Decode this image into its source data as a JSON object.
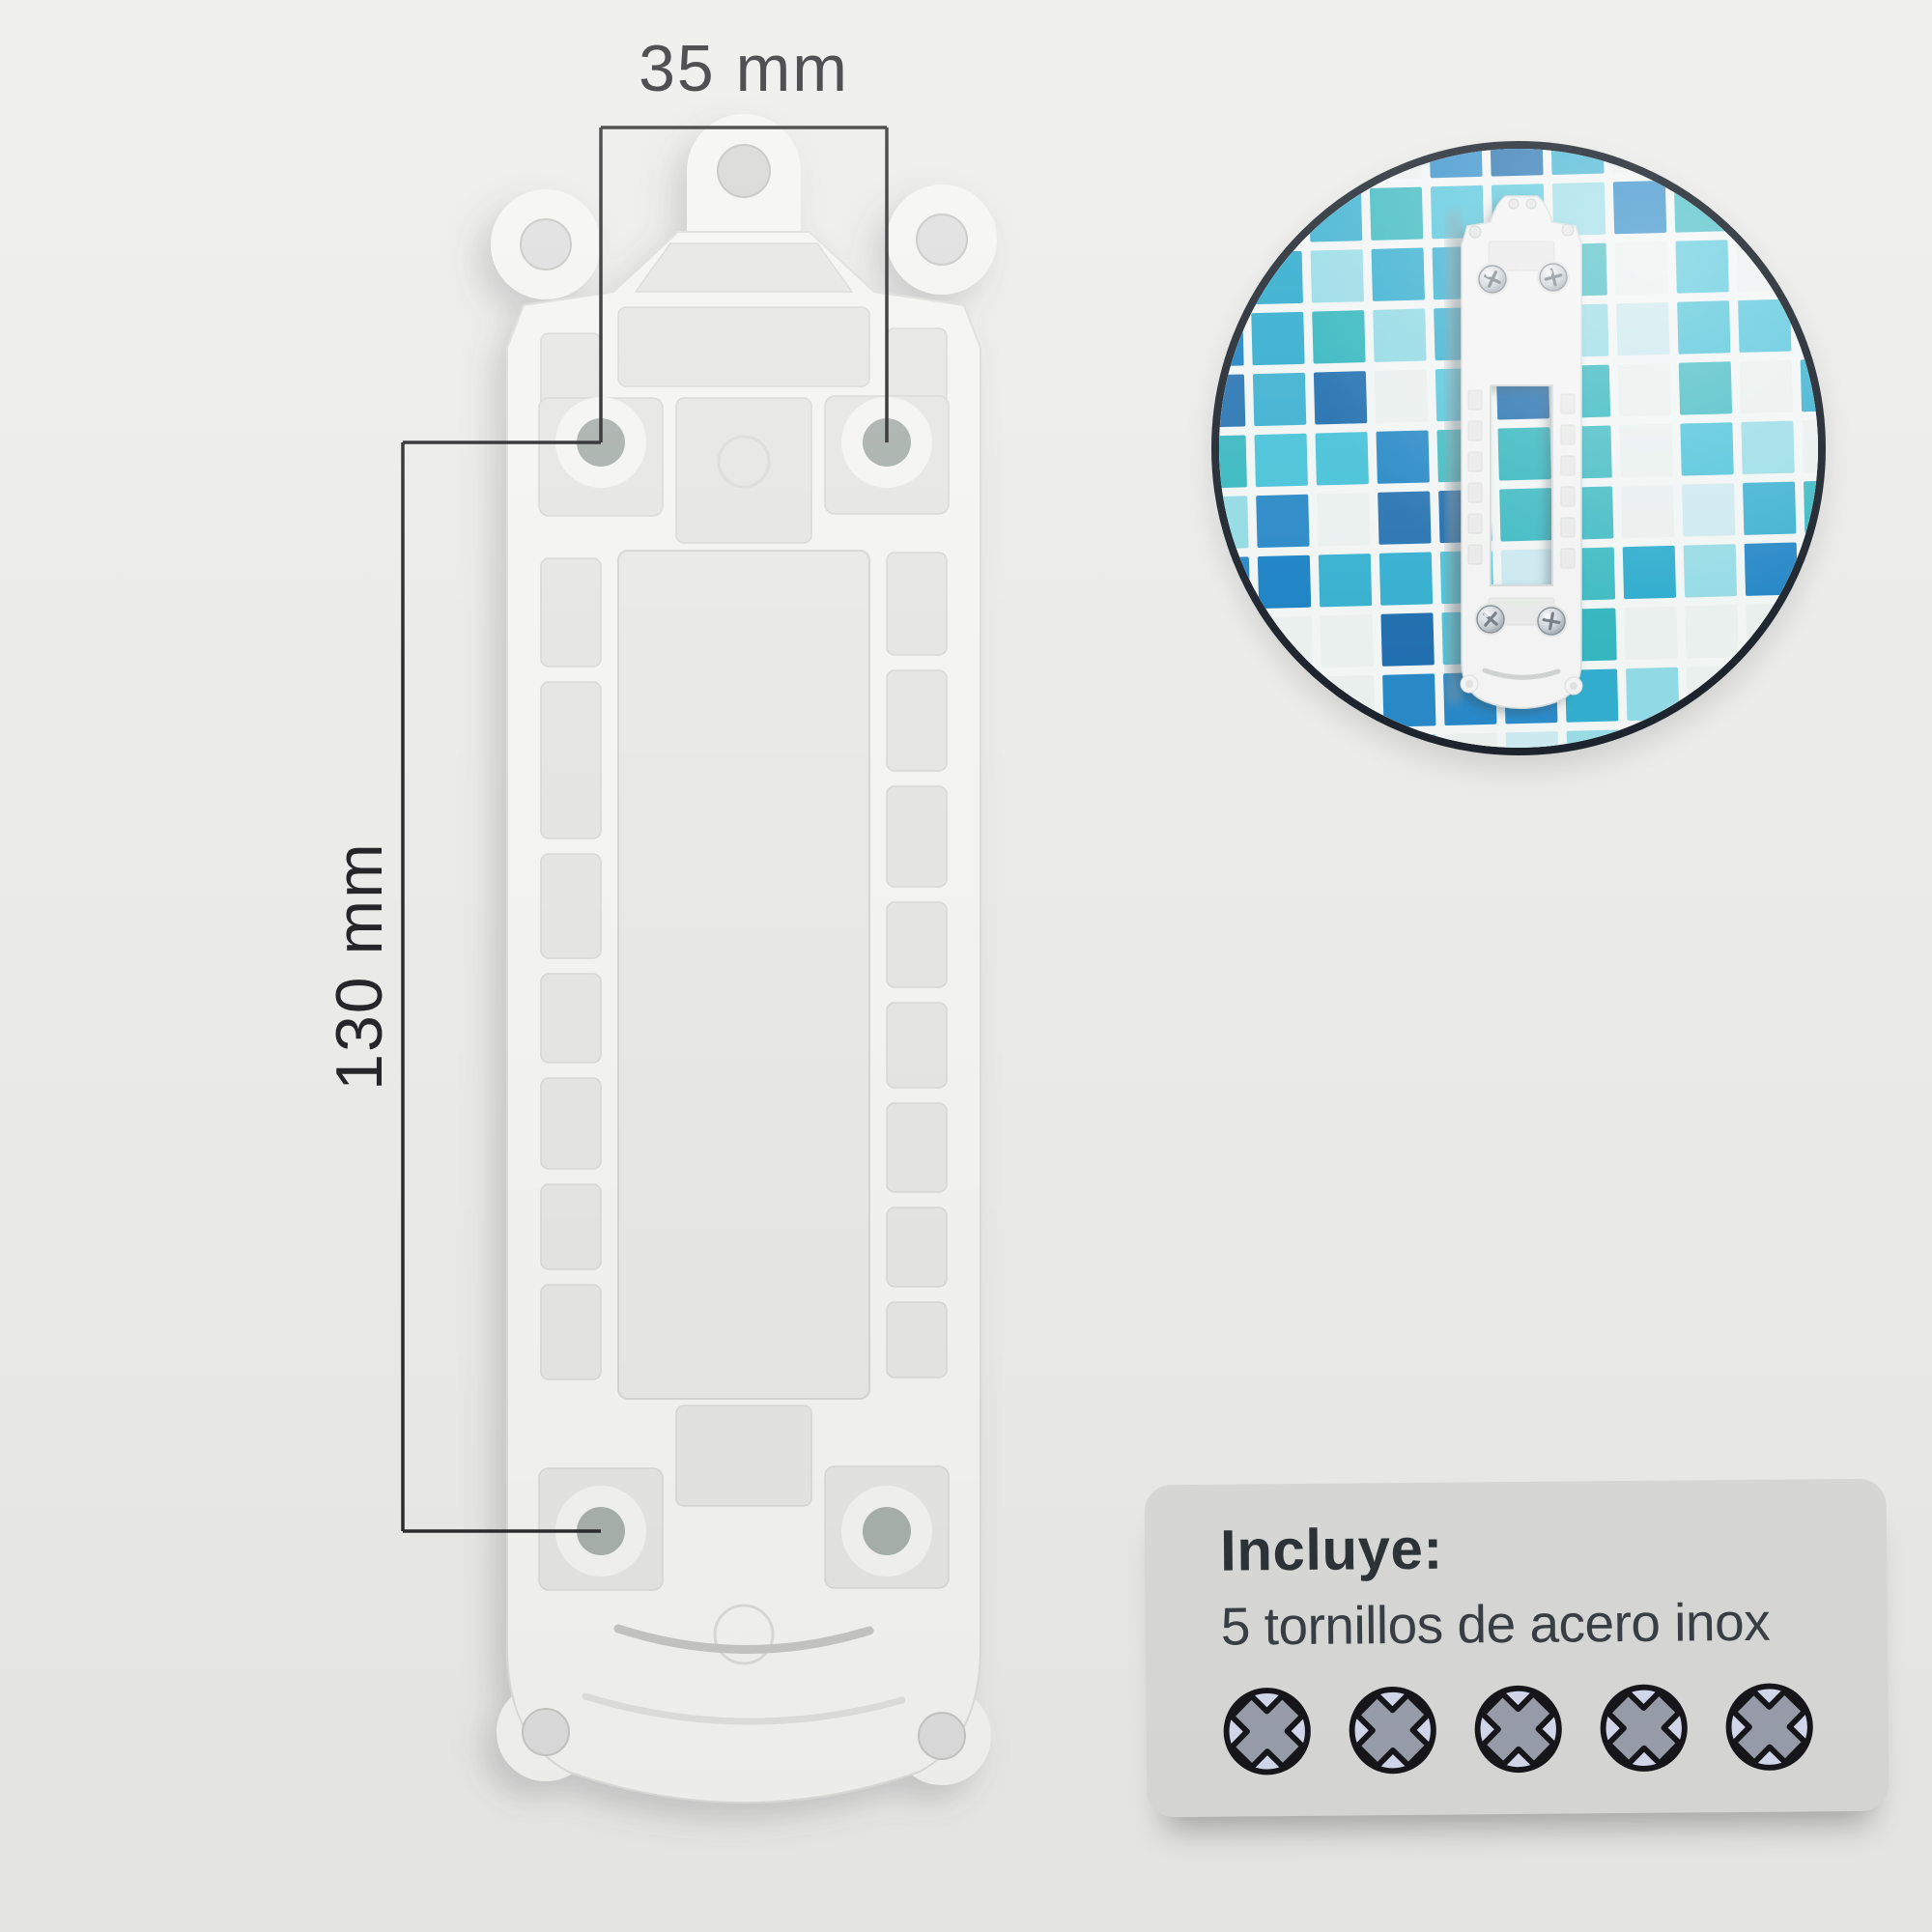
{
  "theme": {
    "bg": "#ececea",
    "line": "#2c2c2e",
    "ink": "#26262a",
    "plate": "#f4f4f2",
    "pocket": "#e6e6e4",
    "window": "#e9e9e7",
    "hole": "#a9b1ad",
    "card_bg": "#dbdbd9",
    "card_ink": "#2e3338",
    "inset_border": "#1d242d",
    "screw_fill": "#d6dbf0",
    "screw_cross": "#9aa0ac",
    "icon_outline": "#17171b",
    "screw_metal": "#c9d0d6"
  },
  "dimensions": {
    "width_label": "35 mm",
    "height_label": "130 mm"
  },
  "inset": {
    "grout": "#f1f5f4",
    "mosaic_palette": [
      "#1c82c4",
      "#1668ab",
      "#27a9cc",
      "#45c1d8",
      "#2db4bd",
      "#8fd9e4",
      "#e8efed",
      "#c9e8ee"
    ]
  },
  "card": {
    "title": "Incluye:",
    "subtitle": "5 tornillos de acero inox",
    "screws_count": 5
  }
}
